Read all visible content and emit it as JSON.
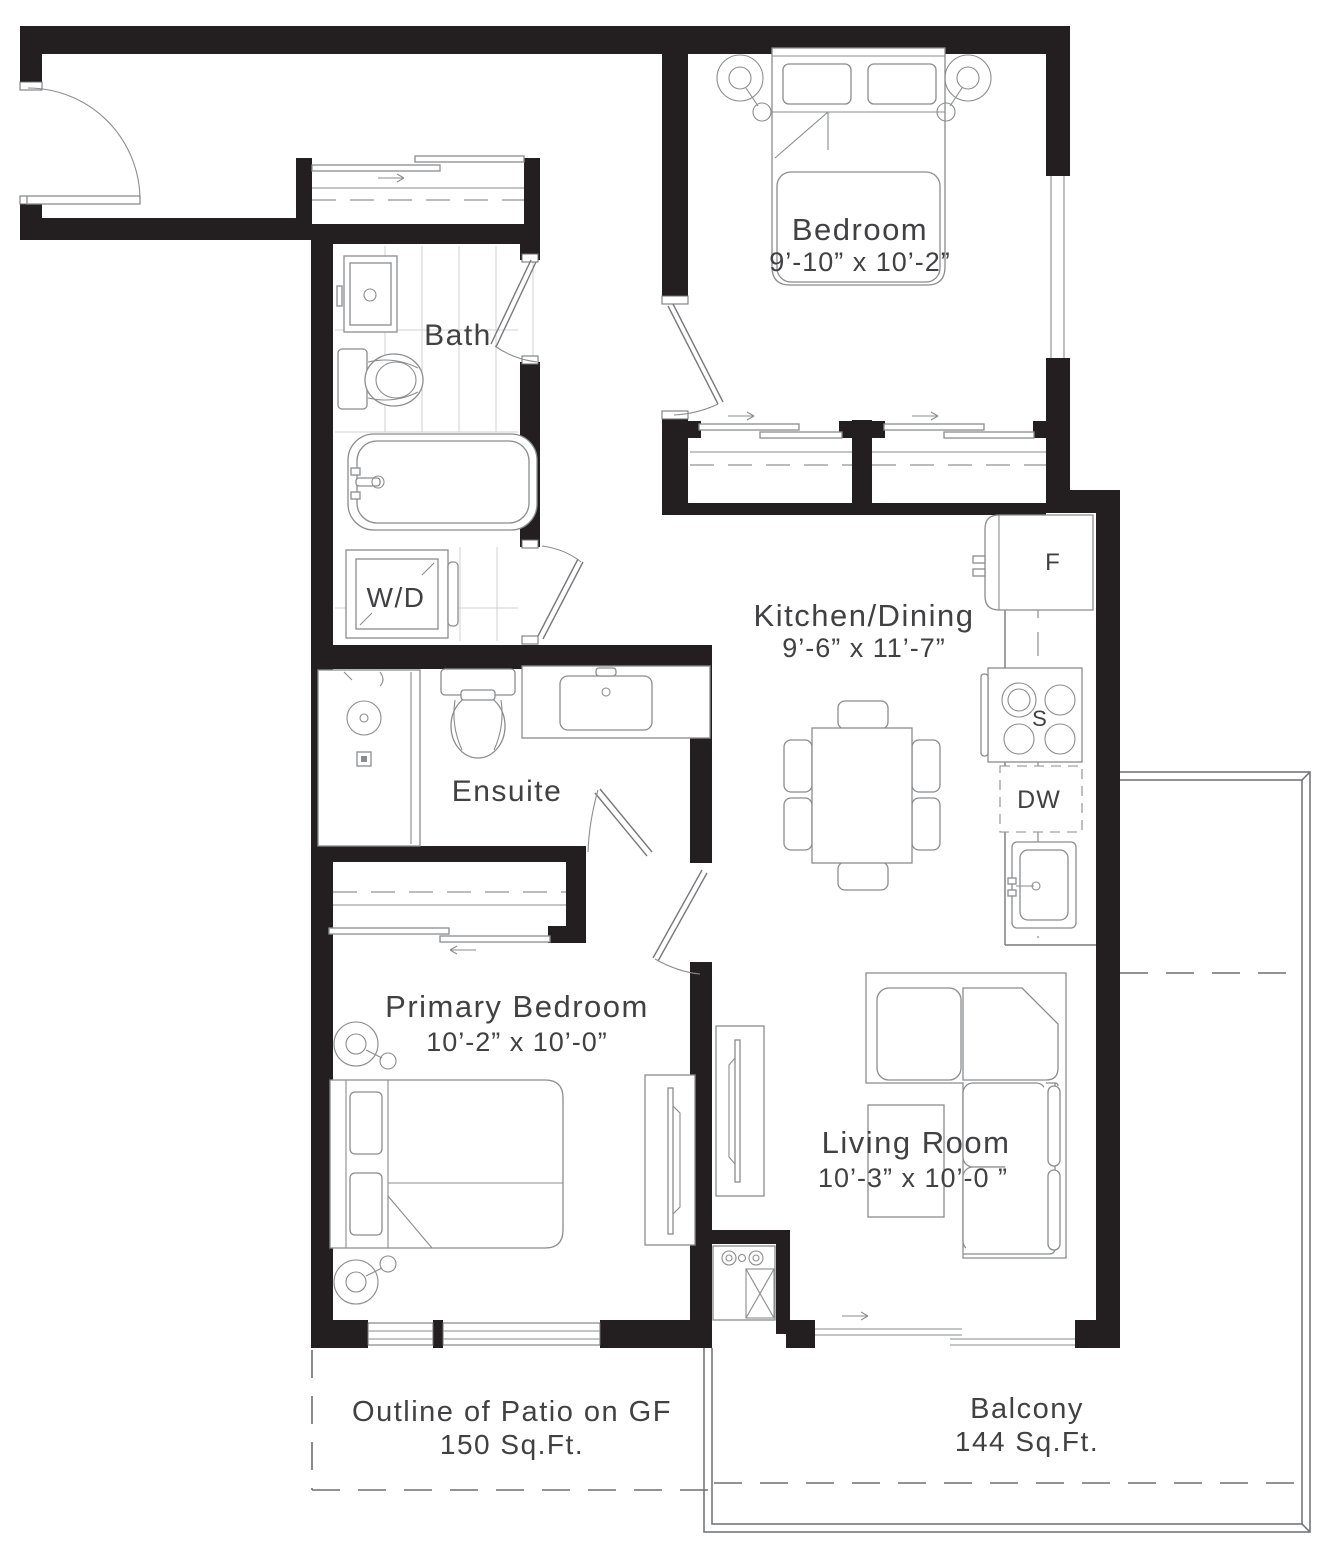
{
  "plan": {
    "title": "One-bedroom + den floor plan",
    "rooms": {
      "bedroom": {
        "name": "Bedroom",
        "dims": "9’-10” x 10’-2”"
      },
      "bath": {
        "name": "Bath"
      },
      "laundry": {
        "label": "W/D"
      },
      "kitchen": {
        "name": "Kitchen/Dining",
        "dims": "9’-6” x 11’-7”"
      },
      "ensuite": {
        "name": "Ensuite"
      },
      "primary": {
        "name": "Primary Bedroom",
        "dims": "10’-2” x 10’-0”"
      },
      "living": {
        "name": "Living  Room",
        "dims": "10’-3” x 10’-0 ”"
      },
      "patio": {
        "name": "Outline of Patio on GF",
        "area": "150 Sq.Ft."
      },
      "balcony": {
        "name": "Balcony",
        "area": "144 Sq.Ft."
      }
    },
    "appliances": {
      "fridge": "F",
      "stove": "S",
      "dishwasher": "DW"
    },
    "colors": {
      "wall": "#231f20",
      "fixture_line": "#8a8c8e",
      "outline": "#6d6e71",
      "text": "#414042"
    }
  }
}
